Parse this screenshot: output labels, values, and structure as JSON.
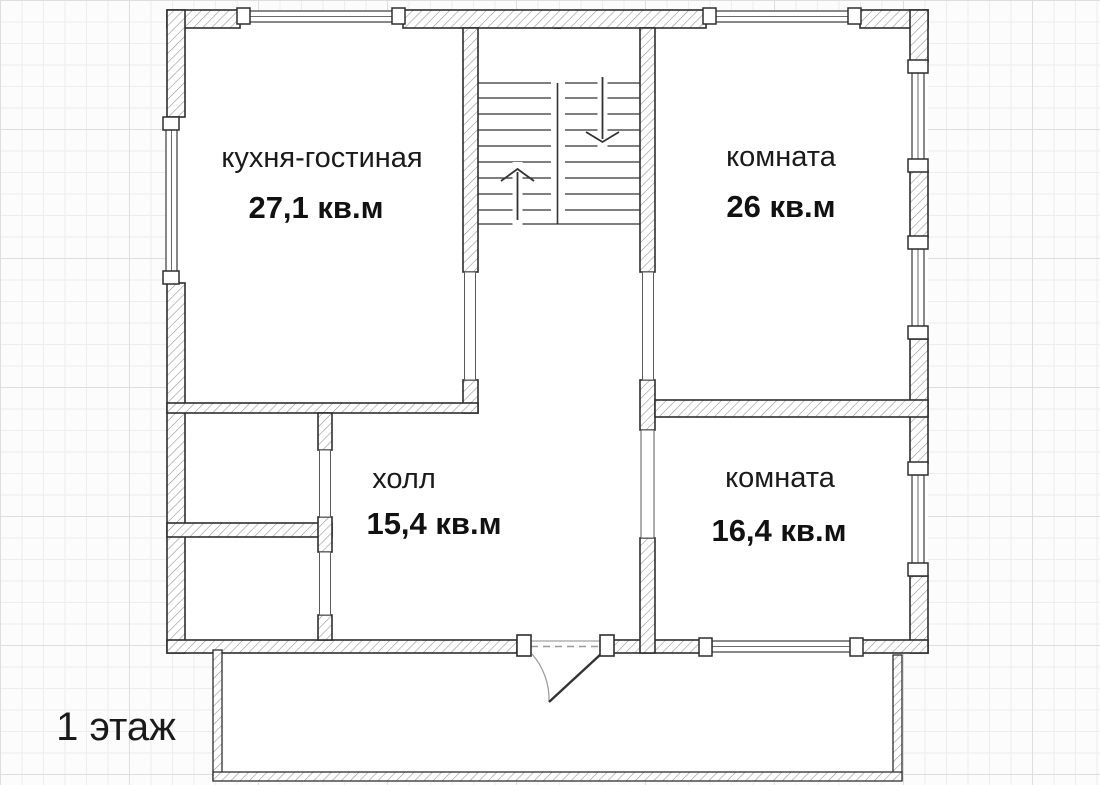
{
  "floor_plan": {
    "floor_label": "1 этаж",
    "rooms": [
      {
        "name": "кухня-гостиная",
        "area": "27,1 кв.м"
      },
      {
        "name": "комната",
        "area": "26 кв.м"
      },
      {
        "name": "холл",
        "area": "15,4 кв.м"
      },
      {
        "name": "комната",
        "area": "16,4 кв.м"
      }
    ]
  },
  "colors": {
    "wall_outline": "#2e2e2e",
    "wall_hatch": "#969696",
    "text": "#1a1a1a",
    "grid_minor": "#ededed",
    "grid_major": "#dedede",
    "background": "#fcfcfc"
  }
}
